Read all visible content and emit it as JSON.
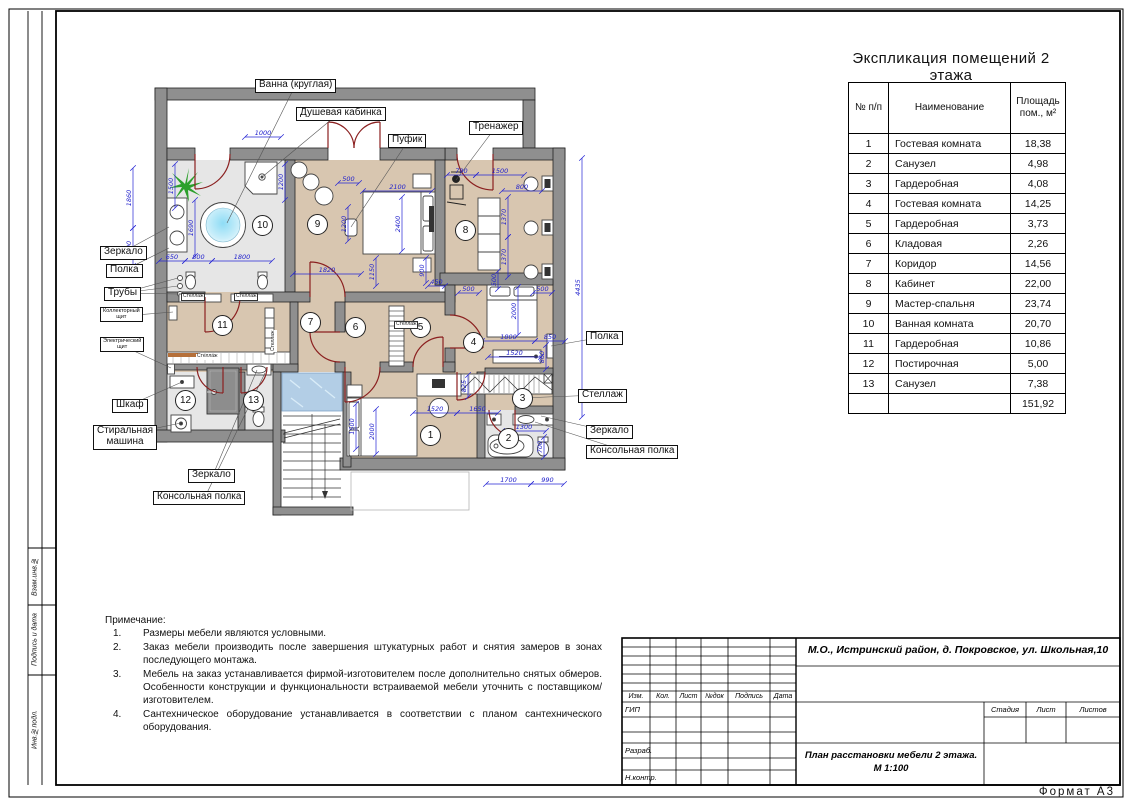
{
  "table": {
    "title": "Экспликация помещений 2 этажа",
    "col_headers": [
      "№ п/п",
      "Наименование",
      "Площадь\nпом., м²"
    ],
    "rows": [
      [
        "1",
        "Гостевая комната",
        "18,38"
      ],
      [
        "2",
        "Санузел",
        "4,98"
      ],
      [
        "3",
        "Гардеробная",
        "4,08"
      ],
      [
        "4",
        "Гостевая комната",
        "14,25"
      ],
      [
        "5",
        "Гардеробная",
        "3,73"
      ],
      [
        "6",
        "Кладовая",
        "2,26"
      ],
      [
        "7",
        "Коридор",
        "14,56"
      ],
      [
        "8",
        "Кабинет",
        "22,00"
      ],
      [
        "9",
        "Мастер-спальня",
        "23,74"
      ],
      [
        "10",
        "Ванная комната",
        "20,70"
      ],
      [
        "11",
        "Гардеробная",
        "10,86"
      ],
      [
        "12",
        "Постирочная",
        "5,00"
      ],
      [
        "13",
        "Санузел",
        "7,38"
      ]
    ],
    "total": "151,92"
  },
  "notes": {
    "heading": "Примечание:",
    "items": [
      {
        "n": "1.",
        "t": "Размеры мебели являются условными."
      },
      {
        "n": "2.",
        "t": "Заказ мебели производить после завершения штукатурных работ и снятия замеров в зонах последующего монтажа."
      },
      {
        "n": "3.",
        "t": "Мебель на заказ устанавливается фирмой-изготовителем после дополнительно снятых обмеров. Особенности конструкции и функциональности встраиваемой мебели уточнить с поставщиком/изготовителем."
      },
      {
        "n": "4.",
        "t": "Сантехническое оборудование устанавливается в соответствии с планом сантехнического оборудования."
      }
    ]
  },
  "title_block": {
    "address": "М.О., Истринский район, д. Покровское, ул. Школьная,10",
    "doc_title_line1": "План расстановки мебели 2 этажа.",
    "doc_title_line2": "М 1:100",
    "header_cols": [
      "Изм.",
      "Кол.",
      "Лист",
      "№док",
      "Подпись",
      "Дата"
    ],
    "gip": "ГИП",
    "razrab": "Разраб.",
    "nkontr": "Н.контр.",
    "stage_label": "Стадия",
    "sheet_label": "Лист",
    "sheets_label": "Листов"
  },
  "frame": {
    "format": "Формат А3",
    "side": [
      "Взам.инв.№",
      "Подпись и дата",
      "Инв.№подл."
    ]
  },
  "colors": {
    "dimension_blue": "#2424d4",
    "door_red": "#8b2020",
    "wall_gray": "#8f8f8f",
    "floor_beige": "#d8c6b0",
    "floor_gray": "#e6e6e6",
    "glass_blue": "#a6c6e2",
    "plant_green": "#2ca02c"
  },
  "plan": {
    "rooms": [
      {
        "n": "1",
        "x": 335,
        "y": 355
      },
      {
        "n": "2",
        "x": 413,
        "y": 358
      },
      {
        "n": "3",
        "x": 427,
        "y": 318
      },
      {
        "n": "4",
        "x": 378,
        "y": 262
      },
      {
        "n": "5",
        "x": 325,
        "y": 247
      },
      {
        "n": "6",
        "x": 260,
        "y": 247
      },
      {
        "n": "7",
        "x": 215,
        "y": 242
      },
      {
        "n": "8",
        "x": 370,
        "y": 150
      },
      {
        "n": "9",
        "x": 222,
        "y": 144
      },
      {
        "n": "10",
        "x": 167,
        "y": 145
      },
      {
        "n": "11",
        "x": 127,
        "y": 245
      },
      {
        "n": "12",
        "x": 90,
        "y": 320
      },
      {
        "n": "13",
        "x": 158,
        "y": 320
      }
    ],
    "callouts": [
      {
        "t": "Ванна (круглая)",
        "x": 160,
        "y": -1,
        "ax": 200,
        "ay": 6,
        "targets": [
          [
            132,
            143
          ]
        ]
      },
      {
        "t": "Душевая кабинка",
        "x": 201,
        "y": 27,
        "ax": 243,
        "ay": 34,
        "targets": [
          [
            166,
            98
          ]
        ]
      },
      {
        "t": "Пуфик",
        "x": 293,
        "y": 54,
        "ax": 313,
        "ay": 61,
        "targets": [
          [
            256,
            147
          ]
        ]
      },
      {
        "t": "Тренажер",
        "x": 374,
        "y": 41,
        "ax": 400,
        "ay": 48,
        "targets": [
          [
            361,
            100
          ]
        ]
      },
      {
        "t": "Зеркало",
        "x": 5,
        "y": 166,
        "ax": 28,
        "ay": 172,
        "targets": [
          [
            74,
            147
          ]
        ]
      },
      {
        "t": "Полка",
        "x": 11,
        "y": 184,
        "ax": 30,
        "ay": 190,
        "targets": [
          [
            74,
            168
          ]
        ]
      },
      {
        "t": "Трубы",
        "x": 9,
        "y": 207,
        "ax": 28,
        "ay": 213,
        "targets": [
          [
            83,
            198
          ],
          [
            83,
            206
          ],
          [
            83,
            214
          ]
        ]
      },
      {
        "t": "Коллекторный\nщит",
        "x": 5,
        "y": 227,
        "ax": 28,
        "ay": 236,
        "small": true,
        "targets": [
          [
            78,
            232
          ]
        ]
      },
      {
        "t": "Электрический\nщит",
        "x": 5,
        "y": 257,
        "ax": 28,
        "ay": 266,
        "small": true,
        "targets": [
          [
            76,
            288
          ]
        ]
      },
      {
        "t": "Шкаф",
        "x": 17,
        "y": 319,
        "ax": 35,
        "ay": 325,
        "targets": [
          [
            87,
            302
          ]
        ]
      },
      {
        "t": "Стиральная\nмашина",
        "x": -2,
        "y": 345,
        "ax": 28,
        "ay": 355,
        "targets": [
          [
            86,
            343
          ]
        ]
      },
      {
        "t": "Зеркало",
        "x": 93,
        "y": 389,
        "ax": 118,
        "ay": 395,
        "targets": [
          [
            162,
            290
          ]
        ]
      },
      {
        "t": "Консольная полка",
        "x": 58,
        "y": 411,
        "ax": 110,
        "ay": 417,
        "targets": [
          [
            170,
            293
          ]
        ]
      },
      {
        "t": "Полка",
        "x": 491,
        "y": 251,
        "ax": 508,
        "ay": 257,
        "targets": [
          [
            456,
            266
          ]
        ]
      },
      {
        "t": "Стеллаж",
        "x": 483,
        "y": 309,
        "ax": 505,
        "ay": 315,
        "targets": [
          [
            425,
            318
          ]
        ]
      },
      {
        "t": "Зеркало",
        "x": 491,
        "y": 345,
        "ax": 512,
        "ay": 351,
        "targets": [
          [
            446,
            336
          ]
        ]
      },
      {
        "t": "Консольная полка",
        "x": 491,
        "y": 365,
        "ax": 530,
        "ay": 371,
        "targets": [
          [
            440,
            342
          ]
        ]
      }
    ],
    "mini_labels": [
      {
        "t": "Стеллаж",
        "x": 86,
        "y": 213,
        "boxed": true
      },
      {
        "t": "Стеллаж",
        "x": 139,
        "y": 213,
        "boxed": true
      },
      {
        "t": "Стеллаж",
        "x": 176,
        "y": 272,
        "rot": true
      },
      {
        "t": "Стеллаж",
        "x": 101,
        "y": 274,
        "boxed": false
      },
      {
        "t": "Стеллаж",
        "x": 299,
        "y": 241,
        "boxed": true
      }
    ],
    "dims": [
      {
        "t": "1860",
        "x1": 38,
        "y1": 88,
        "x2": 38,
        "y2": 148
      },
      {
        "t": "900",
        "x1": 38,
        "y1": 148,
        "x2": 38,
        "y2": 186
      },
      {
        "t": "1500",
        "x1": 80,
        "y1": 84,
        "x2": 80,
        "y2": 128
      },
      {
        "t": "1690",
        "x1": 100,
        "y1": 120,
        "x2": 100,
        "y2": 176
      },
      {
        "t": "650",
        "x1": 64,
        "y1": 181,
        "x2": 90,
        "y2": 181
      },
      {
        "t": "800",
        "x1": 90,
        "y1": 181,
        "x2": 117,
        "y2": 181
      },
      {
        "t": "1800",
        "x1": 117,
        "y1": 181,
        "x2": 177,
        "y2": 181
      },
      {
        "t": "1000",
        "x1": 150,
        "y1": 57,
        "x2": 186,
        "y2": 57
      },
      {
        "t": "1200",
        "x1": 190,
        "y1": 84,
        "x2": 190,
        "y2": 120
      },
      {
        "t": "500",
        "x1": 243,
        "y1": 103,
        "x2": 264,
        "y2": 103
      },
      {
        "t": "2100",
        "x1": 268,
        "y1": 111,
        "x2": 337,
        "y2": 111
      },
      {
        "t": "2400",
        "x1": 307,
        "y1": 117,
        "x2": 307,
        "y2": 171
      },
      {
        "t": "1200",
        "x1": 253,
        "y1": 127,
        "x2": 253,
        "y2": 161
      },
      {
        "t": "1820",
        "x1": 198,
        "y1": 194,
        "x2": 266,
        "y2": 194
      },
      {
        "t": "1150",
        "x1": 281,
        "y1": 178,
        "x2": 281,
        "y2": 206
      },
      {
        "t": "900",
        "x1": 331,
        "y1": 178,
        "x2": 331,
        "y2": 203
      },
      {
        "t": "450",
        "x1": 333,
        "y1": 206,
        "x2": 350,
        "y2": 206
      },
      {
        "t": "790",
        "x1": 352,
        "y1": 95,
        "x2": 381,
        "y2": 95
      },
      {
        "t": "1500",
        "x1": 381,
        "y1": 95,
        "x2": 429,
        "y2": 95
      },
      {
        "t": "800",
        "x1": 407,
        "y1": 111,
        "x2": 447,
        "y2": 111
      },
      {
        "t": "1370",
        "x1": 413,
        "y1": 117,
        "x2": 413,
        "y2": 157
      },
      {
        "t": "1370",
        "x1": 413,
        "y1": 157,
        "x2": 413,
        "y2": 197
      },
      {
        "t": "500",
        "x1": 403,
        "y1": 191,
        "x2": 403,
        "y2": 209
      },
      {
        "t": "4435",
        "x1": 487,
        "y1": 78,
        "x2": 487,
        "y2": 337
      },
      {
        "t": "500",
        "x1": 363,
        "y1": 213,
        "x2": 384,
        "y2": 213
      },
      {
        "t": "500",
        "x1": 438,
        "y1": 213,
        "x2": 457,
        "y2": 213
      },
      {
        "t": "2000",
        "x1": 423,
        "y1": 207,
        "x2": 423,
        "y2": 255
      },
      {
        "t": "1800",
        "x1": 387,
        "y1": 261,
        "x2": 440,
        "y2": 261
      },
      {
        "t": "850",
        "x1": 440,
        "y1": 261,
        "x2": 470,
        "y2": 261
      },
      {
        "t": "1520",
        "x1": 393,
        "y1": 277,
        "x2": 446,
        "y2": 277
      },
      {
        "t": "860",
        "x1": 451,
        "y1": 265,
        "x2": 451,
        "y2": 289
      },
      {
        "t": "1520",
        "x1": 318,
        "y1": 333,
        "x2": 362,
        "y2": 333
      },
      {
        "t": "1650",
        "x1": 362,
        "y1": 333,
        "x2": 403,
        "y2": 333
      },
      {
        "t": "825",
        "x1": 373,
        "y1": 295,
        "x2": 373,
        "y2": 317
      },
      {
        "t": "1500",
        "x1": 261,
        "y1": 324,
        "x2": 261,
        "y2": 369
      },
      {
        "t": "2000",
        "x1": 281,
        "y1": 329,
        "x2": 281,
        "y2": 374
      },
      {
        "t": "1300",
        "x1": 407,
        "y1": 351,
        "x2": 451,
        "y2": 351
      },
      {
        "t": "700",
        "x1": 449,
        "y1": 357,
        "x2": 449,
        "y2": 377
      },
      {
        "t": "1700",
        "x1": 391,
        "y1": 404,
        "x2": 436,
        "y2": 404
      },
      {
        "t": "990",
        "x1": 436,
        "y1": 404,
        "x2": 469,
        "y2": 404
      }
    ]
  }
}
